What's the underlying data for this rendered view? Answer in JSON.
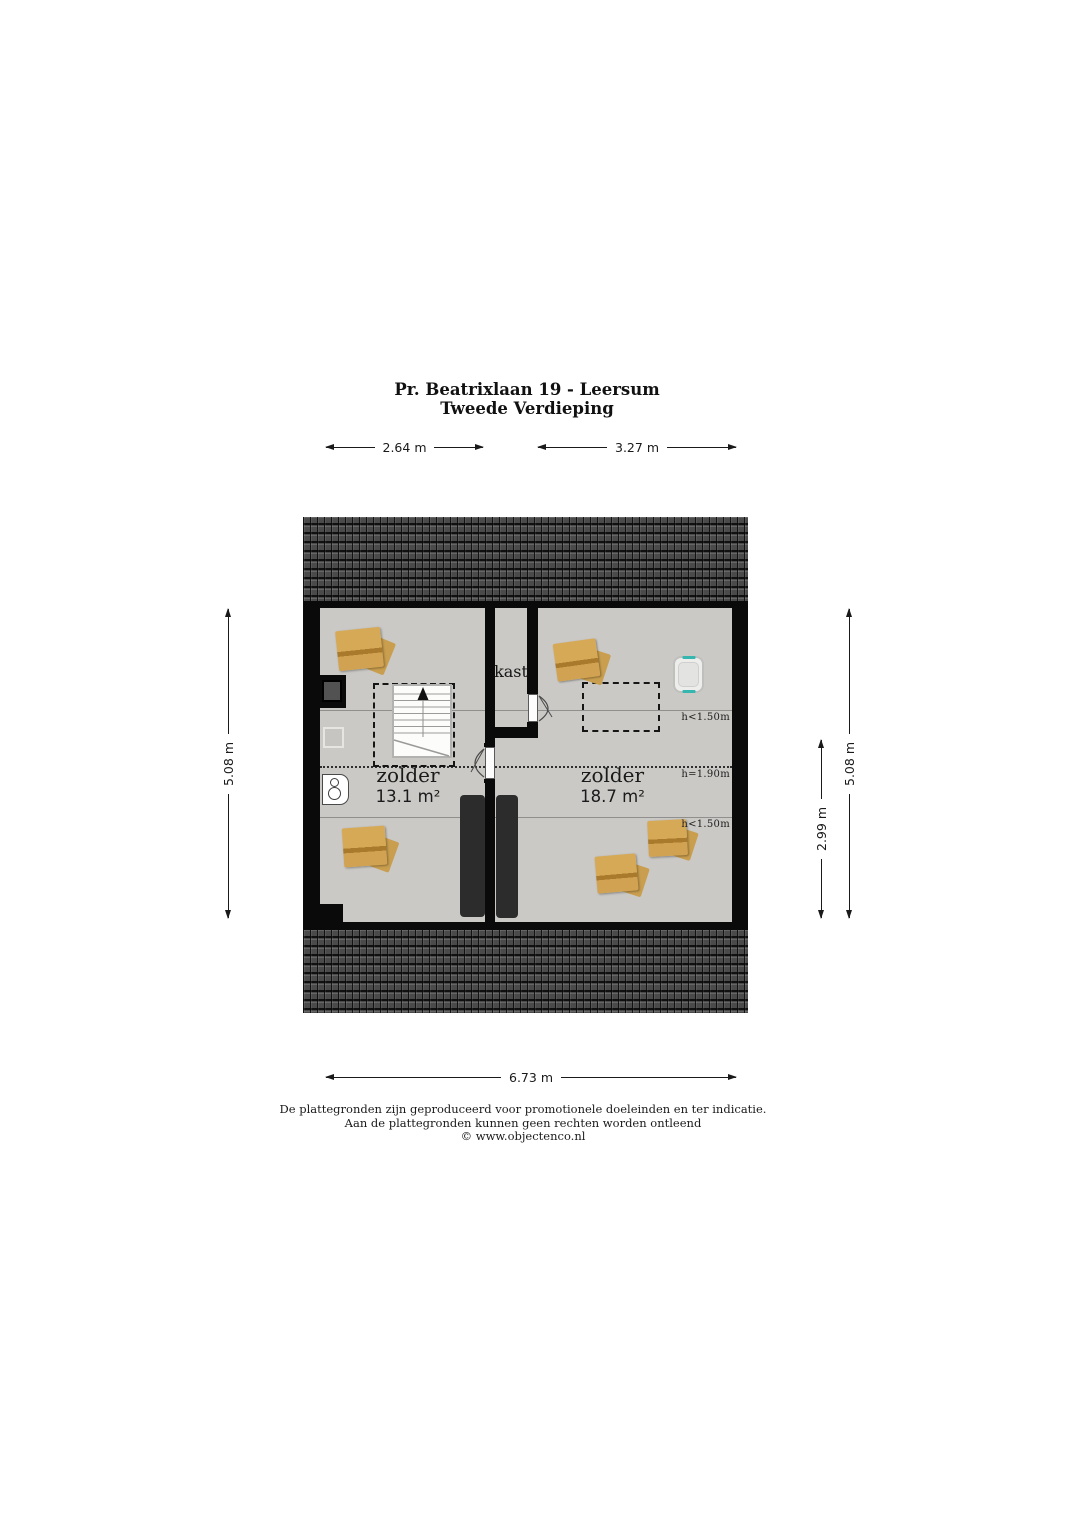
{
  "title": {
    "line1": "Pr. Beatrixlaan 19 - Leersum",
    "line2": "Tweede Verdieping"
  },
  "dimensions": {
    "top_left": "2.64 m",
    "top_right": "3.27 m",
    "left": "5.08 m",
    "right_inner": "2.99 m",
    "right_outer": "5.08 m",
    "bottom": "6.73 m"
  },
  "rooms": {
    "left": {
      "name": "zolder",
      "area": "13.1 m²"
    },
    "right": {
      "name": "zolder",
      "area": "18.7 m²"
    },
    "closet": {
      "name": "kast"
    }
  },
  "height_markers": [
    {
      "label": "h<1.50m"
    },
    {
      "label": "h=1.90m"
    },
    {
      "label": "h<1.50m"
    }
  ],
  "footer": {
    "line1": "De plattegronden zijn geproduceerd voor promotionele doeleinden en ter indicatie.",
    "line2": "Aan de plattegronden kunnen geen rechten worden ontleend",
    "line3": "© www.objectenco.nl"
  },
  "objects": [
    "roof-tiles",
    "staircase-up",
    "stair-void-outline",
    "chimney",
    "storage-boxes",
    "gray-cabinet",
    "boiler-unit",
    "laundry-basket",
    "roof-window-outline",
    "mattress-left",
    "mattress-right",
    "closet-door",
    "room-door"
  ],
  "colors": {
    "wall": "#0a0a0a",
    "floor": "#cac9c6",
    "roof": "#4a4a4a",
    "box": "#d6a956",
    "box_stripe": "#aa7a2c",
    "mattress": "#2c2c2c",
    "basket_handle": "#35b6ae"
  }
}
